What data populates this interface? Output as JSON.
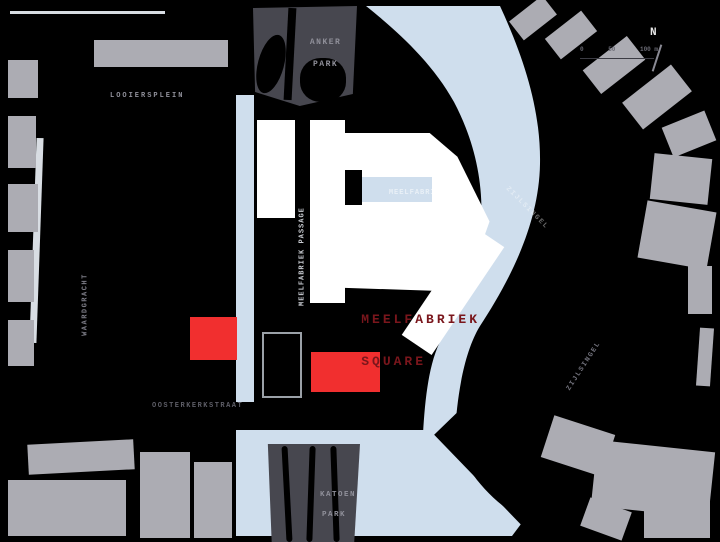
{
  "map": {
    "colors": {
      "bg": "#000000",
      "water": "#cfdeed",
      "building": "#acacb3",
      "park": "#47474f",
      "white_building": "#ffffff",
      "red": "#f12f2f",
      "red_label": "#7a161c",
      "label": "#90909a",
      "label_dark": "#5d5d66",
      "edge_line": "#d8dde3"
    },
    "labels": {
      "anker_park_1": "ANKER",
      "anker_park_2": "PARK",
      "looiersplein": "LOOIERSPLEIN",
      "waardgracht": "WAARDGRACHT",
      "meelfabriek_passage": "MEELFABRIEK PASSAGE",
      "square_1": "MEELFABRIEK",
      "square_2": "SQUARE",
      "plein_1": "MEELFABRIEK",
      "plein_2": "PLEIN",
      "zijlsingel_water": "ZIJLSINGEL",
      "zijlsingel_street": "ZIJLSINGEL",
      "oosterkerkstraat": "OOSTERKERKSTRAAT",
      "katoen_park_1": "KATOEN",
      "katoen_park_2": "PARK",
      "compass": "N",
      "scale_0": "0",
      "scale_50": "50",
      "scale_100": "100 m"
    }
  }
}
